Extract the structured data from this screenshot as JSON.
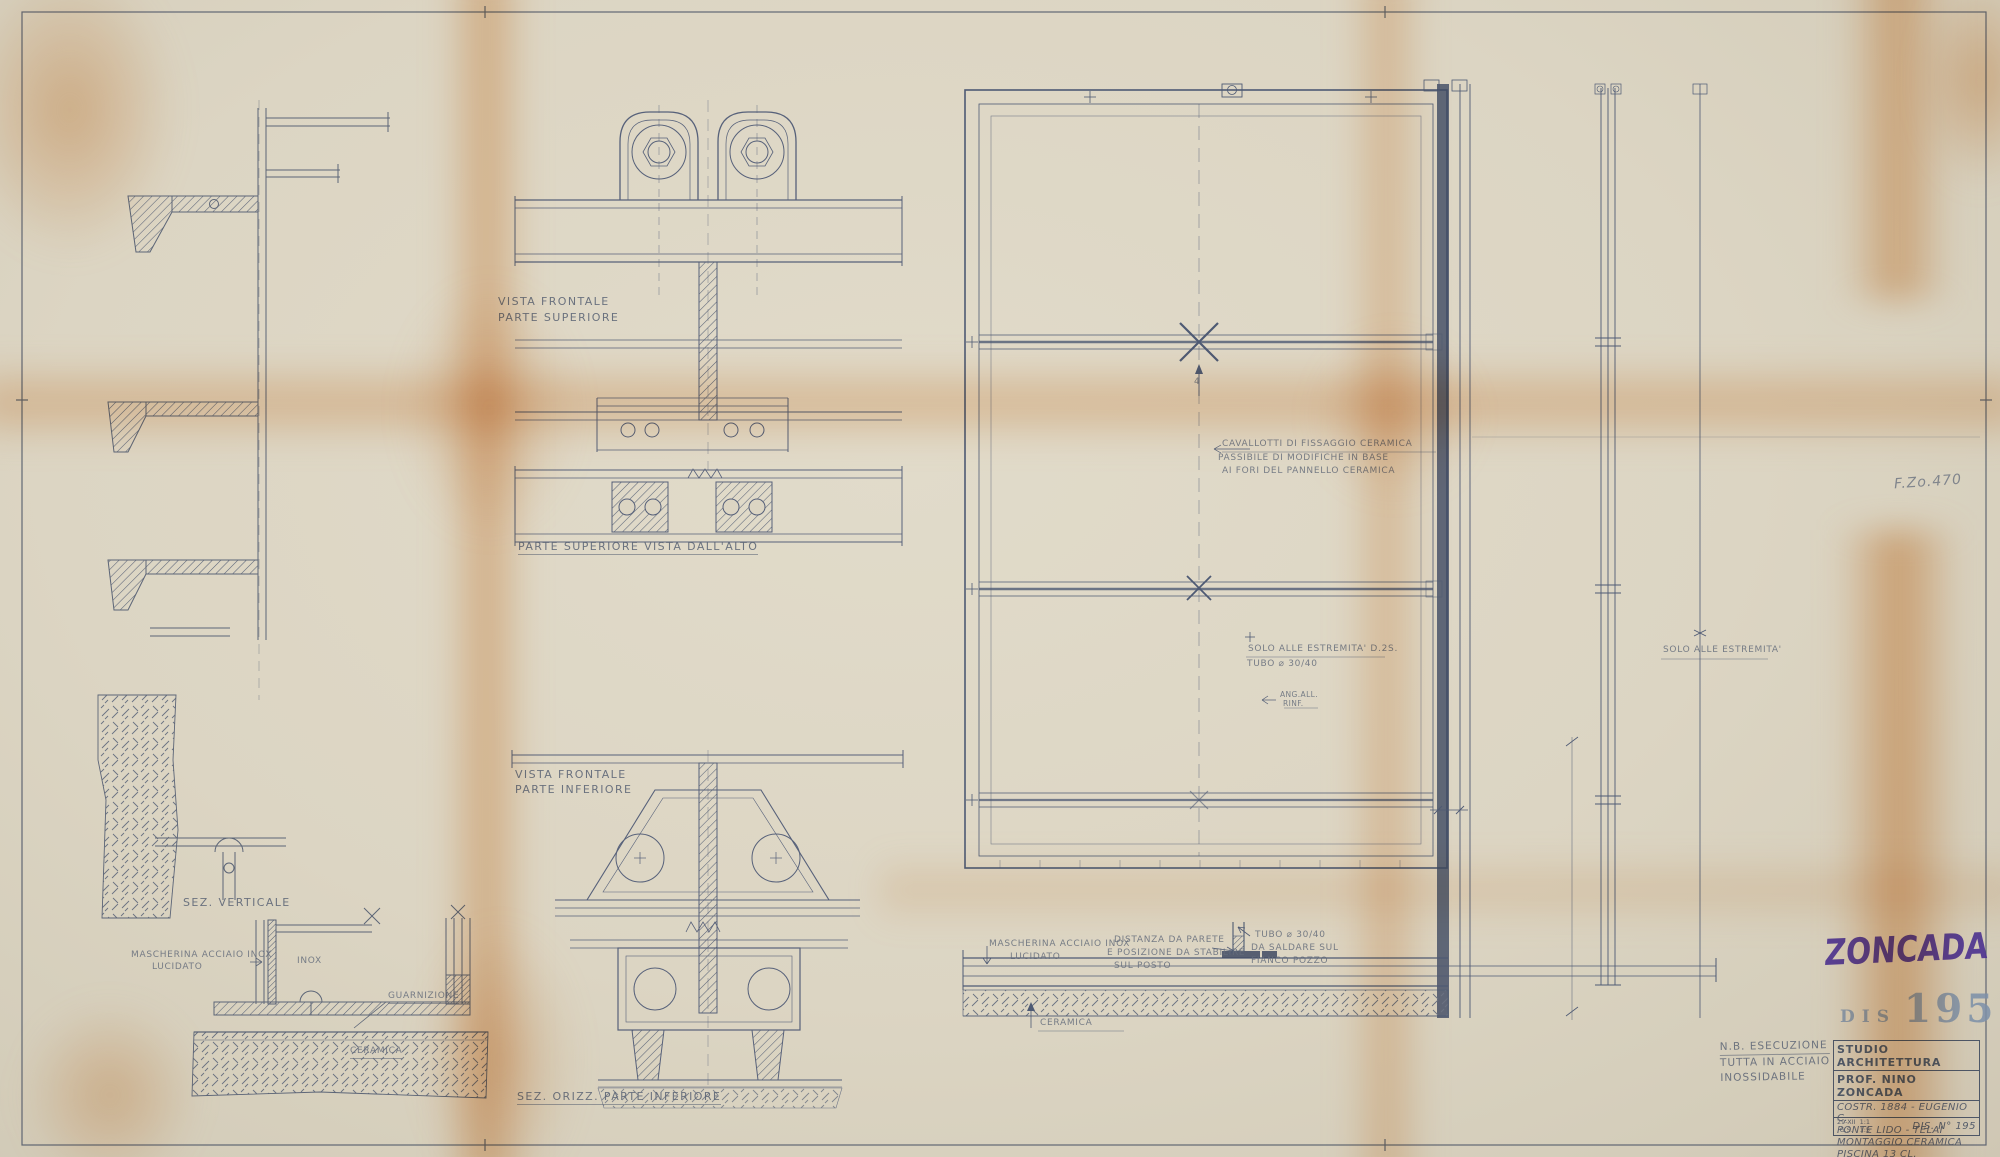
{
  "sheet": {
    "logo_text": "ZONCADA",
    "ref_code": "F.Zo.470"
  },
  "left_details": {
    "sez_verticale": "SEZ. VERTICALE",
    "mascherina_line1": "MASCHERINA ACCIAIO INOX",
    "mascherina_line2": "LUCIDATO",
    "inox": "INOX",
    "guarnizione": "GUARNIZIONE",
    "ceramica": "CERAMICA"
  },
  "middle_details": {
    "vista_sup_line1": "VISTA FRONTALE",
    "vista_sup_line2": "PARTE SUPERIORE",
    "vista_alto": "PARTE SUPERIORE VISTA DALL'ALTO",
    "vista_inf_line1": "VISTA FRONTALE",
    "vista_inf_line2": "PARTE INFERIORE",
    "sez_orizz": "SEZ. ORIZZ. PARTE INFERIORE"
  },
  "frame_details": {
    "fissaggio_line1": "CAVALLOTTI DI FISSAGGIO CERAMICA",
    "fissaggio_line2": "PASSIBILE DI MODIFICHE IN BASE",
    "fissaggio_line3": "AI FORI DEL PANNELLO CERAMICA",
    "marker_4": "4",
    "estremita_d2s": "SOLO ALLE ESTREMITA' D.2S.",
    "tubo_3040": "TUBO ⌀ 30/40",
    "ang_all": "ANG.ALL.",
    "rinf": "RINF.",
    "estremita_right": "SOLO ALLE ESTREMITA'",
    "mascherina_line1": "MASCHERINA ACCIAIO INOX",
    "mascherina_line2": "LUCIDATO",
    "distanza_line1": "DISTANZA DA PARETE",
    "distanza_line2": "E POSIZIONE DA STABILIRE",
    "distanza_line3": "SUL POSTO",
    "tubo_saldare_line1": "TUBO ⌀ 30/40",
    "tubo_saldare_line2": "DA SALDARE SUL",
    "tubo_saldare_line3": "FIANCO POZZO",
    "ceramica": "CERAMICA"
  },
  "notes": {
    "nb_line1": "N.B. ESECUZIONE",
    "nb_line2": "TUTTA IN ACCIAIO",
    "nb_line3": "INOSSIDABILE"
  },
  "stamp": {
    "dis_label": "DIS",
    "dis_number": "195"
  },
  "title_block": {
    "studio_line1": "STUDIO ARCHITETTURA",
    "studio_line2": "PROF. NINO ZONCADA",
    "job_line1": "COSTR. 1884 - EUGENIO C.",
    "job_line2": "PONTE LIDO - TELAI",
    "job_line3": "MONTAGGIO CERAMICA",
    "job_line4": "PISCINA 13 CL.",
    "date_top": "29-XII",
    "date_bottom": "G.S.",
    "scale_top": "1:1",
    "scale_bottom": "1:5",
    "dis_no_label": "DIS. N°",
    "dis_no_value": "195"
  },
  "colors": {
    "paper": "#dcd5c3",
    "line": "#5a6478",
    "stain": "#dd9550",
    "logo": "#4c3191",
    "stamp": "#7d91aa"
  }
}
